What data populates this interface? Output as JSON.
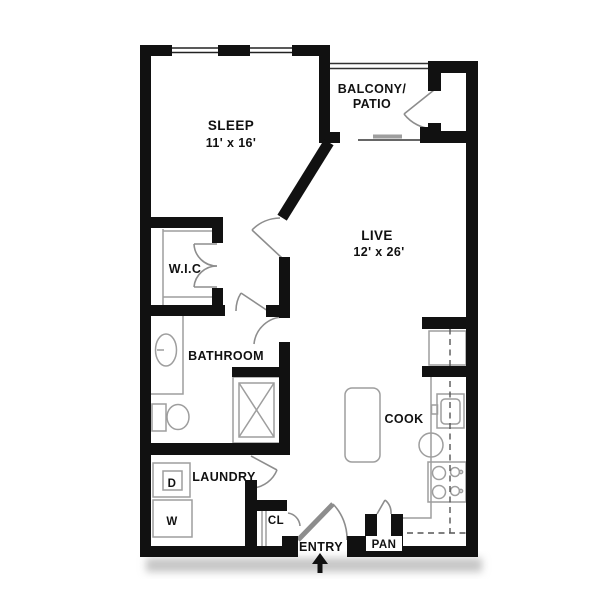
{
  "document": {
    "type": "apartment floor plan",
    "background": "#ffffff"
  },
  "rooms": {
    "sleep": {
      "name": "SLEEP",
      "dims": "11' x 16'"
    },
    "balcony": {
      "name_line1": "BALCONY/",
      "name_line2": "PATIO"
    },
    "live": {
      "name": "LIVE",
      "dims": "12' x 26'"
    },
    "wic": {
      "name": "W.I.C"
    },
    "bathroom": {
      "name": "BATHROOM"
    },
    "cook": {
      "name": "COOK"
    },
    "laundry": {
      "name": "LAUNDRY"
    },
    "closet": {
      "name": "CL"
    },
    "entry": {
      "name": "ENTRY"
    },
    "pantry": {
      "name": "PAN"
    }
  },
  "appliances": {
    "dryer": "D",
    "washer": "W"
  },
  "colors": {
    "wall": "#111111",
    "fixture_line": "#9e9e9e",
    "door_line": "#8d8d8d",
    "dashed_line": "#555555",
    "text": "#111111",
    "shadow": "#c6c6c6",
    "background": "#ffffff"
  }
}
